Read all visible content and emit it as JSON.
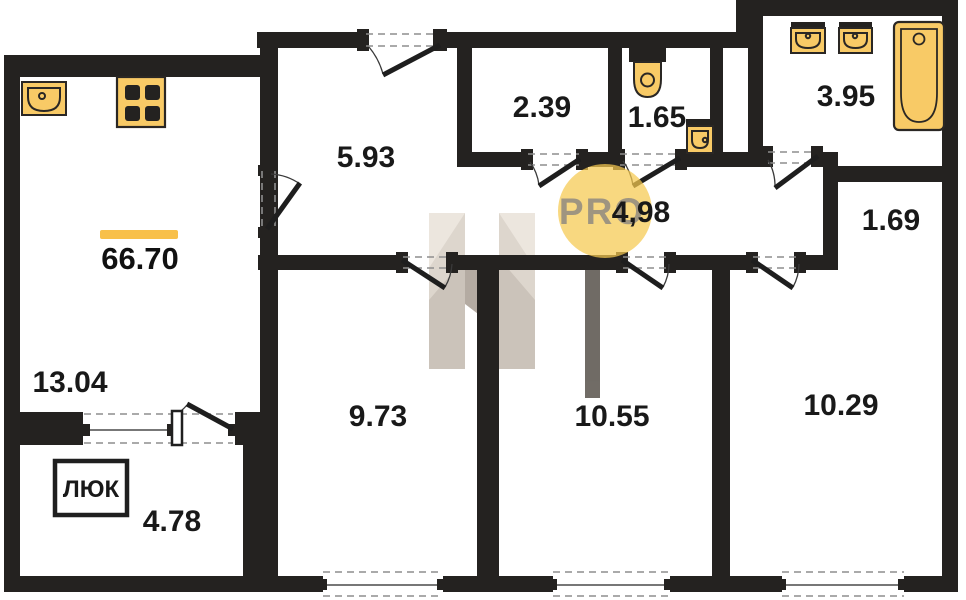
{
  "total_area": {
    "value": "66.70"
  },
  "balcony": {
    "area": "4.78",
    "hatch_label": "ЛЮК"
  },
  "rooms": {
    "kitchen_living": "13.04",
    "hallway": "5.93",
    "storage": "2.39",
    "wc": "1.65",
    "corridor": "4,98",
    "bathroom": "3.95",
    "wardrobe_nook": "1.69",
    "room_left": "9.73",
    "room_middle": "10.55",
    "room_right": "10.29"
  },
  "watermark": {
    "logo_text": "PRO",
    "circle_color": "#F5C94F",
    "text_color": "#8F8A80"
  },
  "colors": {
    "wall": "#242220",
    "fixture_fill": "#F8CA66",
    "fixture_stroke": "#2A2724",
    "accent": "#F8C04A",
    "dash": "#8E8E8E"
  }
}
